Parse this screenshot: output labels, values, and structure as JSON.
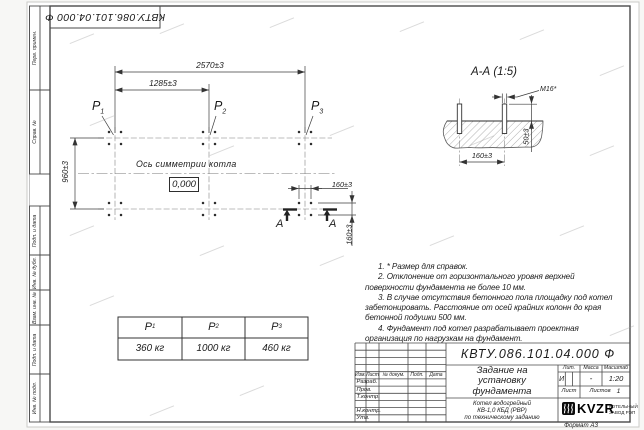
{
  "doc": {
    "number": "КВТУ.086.101.04.000 Ф"
  },
  "frame": {
    "margin_labels": [
      "Перв. примен.",
      "Справ. №",
      "Подп. и дата",
      "Инв. № дубл.",
      "Взам. инв. №",
      "Подп. и дата",
      "Инв. № подл."
    ],
    "format_label": "Формат А3"
  },
  "plan": {
    "dims": {
      "overall": "2570±3",
      "half": "1285±3",
      "depth": "960±3",
      "bolt_x": "160±3",
      "bolt_y": "160±3"
    },
    "loads": [
      {
        "base": "P",
        "sub": "1"
      },
      {
        "base": "P",
        "sub": "2"
      },
      {
        "base": "P",
        "sub": "3"
      }
    ],
    "axis_label": "Ось симметрии котла",
    "level": "0,000",
    "section_letter_left": "А",
    "section_letter_right": "А"
  },
  "section": {
    "title": "А-А (1:5)",
    "thread": "М16*",
    "height": "50±3",
    "spacing": "160±3"
  },
  "notes": [
    "1. * Размер для справок.",
    "2. Отклонение от горизонтального уровня верхней поверхности фундамента не более 10 мм.",
    "3. В случае отсутствия бетонного пола площадку под котел забетонировать. Расстояние от осей крайних колонн до края бетонной подушки 500 мм.",
    "4. Фундамент под котел разрабатывает проектная организация по нагрузкам на фундамент."
  ],
  "load_table": {
    "headers": [
      {
        "base": "P",
        "sub": "1"
      },
      {
        "base": "P",
        "sub": "2"
      },
      {
        "base": "P",
        "sub": "3"
      }
    ],
    "values": [
      "360 кг",
      "1000 кг",
      "460 кг"
    ]
  },
  "title_block": {
    "doc_number": "КВТУ.086.101.04.000 Ф",
    "title_lines": [
      "Задание на",
      "установку",
      "фундамента"
    ],
    "product_lines": [
      "Котел водогрейный",
      "КВ-1,0 КБД (РВР)",
      "по техническому заданию"
    ],
    "cols": {
      "izm": "Изм.",
      "list": "Лист",
      "ndoc": "№ докум.",
      "podp": "Подп.",
      "data": "Дата"
    },
    "rows": {
      "razrab": "Разраб.",
      "prov": "Пров.",
      "tkontr": "Т.контр.",
      "nkontr": "Н.контр.",
      "utv": "Утв."
    },
    "lit_header": "Лит.",
    "mass_header": "Масса",
    "scale_header": "Масштаб",
    "lit": "И",
    "mass": "-",
    "scale": "1:20",
    "sheet_label": "Лист",
    "sheets_label": "Листов",
    "sheets_value": "1",
    "logo_text": "KVZR",
    "logo_sub1": "КОТЕЛЬНЫЙ",
    "logo_sub2": "ЗАВОД РЭП"
  }
}
